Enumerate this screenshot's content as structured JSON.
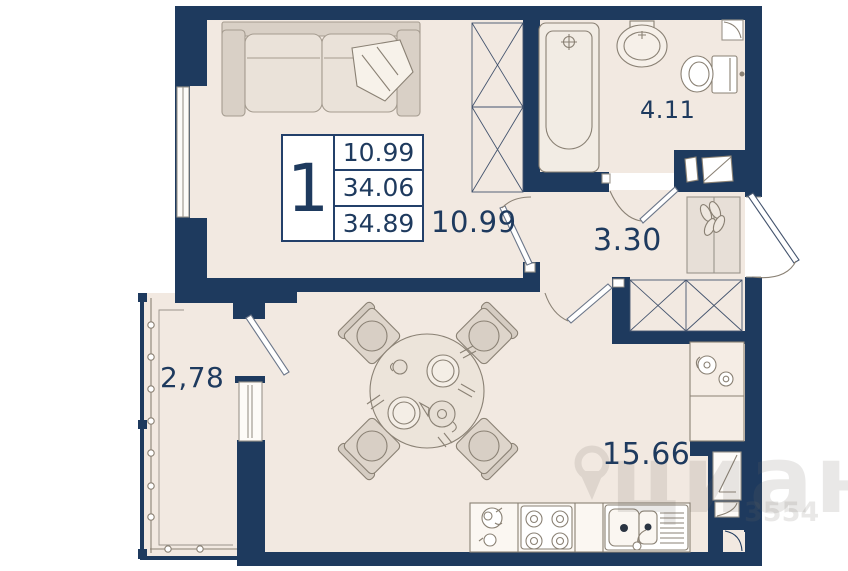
{
  "legend": {
    "rooms_count": "1",
    "living_area": "10.99",
    "area": "34.06",
    "total_area": "34.89"
  },
  "rooms": {
    "bedroom": {
      "label": "10.99"
    },
    "bathroom": {
      "label": "4.11"
    },
    "hallway": {
      "label": "3.30"
    },
    "kitchen_living": {
      "label": "15.66"
    },
    "balcony": {
      "label": "2,78"
    }
  },
  "watermark": {
    "brand": "циан",
    "code": "3554"
  },
  "colors": {
    "wall": "#1e3a5e",
    "floor": "#f2e9e1",
    "furniture_line": "#8a8174",
    "label_text": "#1e3a5e",
    "white": "#ffffff"
  }
}
